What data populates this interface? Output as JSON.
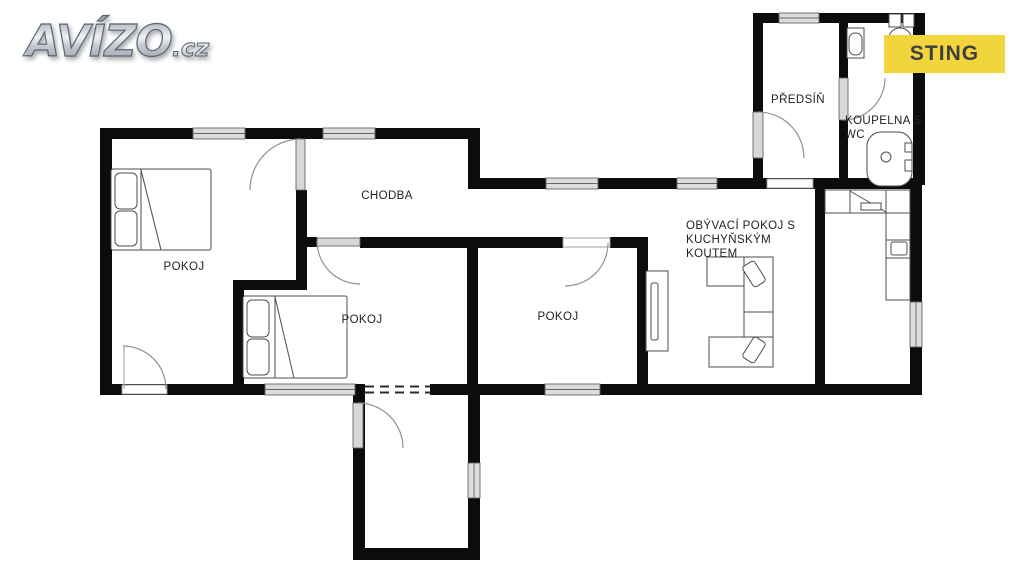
{
  "branding": {
    "logo_text": "AVÍZO",
    "logo_suffix": ".cz",
    "agency_badge": "STING"
  },
  "colors": {
    "badge_background": "#F2D53D",
    "badge_text": "#3F3F3F",
    "wall": "#0C0C0C",
    "window_fill": "#DCDCDC",
    "fixture_line": "#4D4D4D",
    "door_arc": "#909090",
    "label_text": "#222222"
  },
  "floor_plan": {
    "rooms": [
      {
        "id": "predsin",
        "label": "PŘEDSÍŇ"
      },
      {
        "id": "koupelna",
        "label": "KOUPELNA S WC"
      },
      {
        "id": "chodba",
        "label": "CHODBA"
      },
      {
        "id": "pokoj-1",
        "label": "POKOJ"
      },
      {
        "id": "pokoj-2",
        "label": "POKOJ"
      },
      {
        "id": "pokoj-3",
        "label": "POKOJ"
      },
      {
        "id": "obyvaci",
        "label": "OBÝVACÍ POKOJ S KUCHYŇSKÝM KOUTEM"
      }
    ],
    "fixture_icons": [
      "double-bed-icon",
      "double-bed-icon",
      "corner-sofa-icon",
      "tv-sideboard-icon",
      "kitchen-counter-icon",
      "bathtub-icon",
      "toilet-icon",
      "washbasin-icon"
    ]
  }
}
